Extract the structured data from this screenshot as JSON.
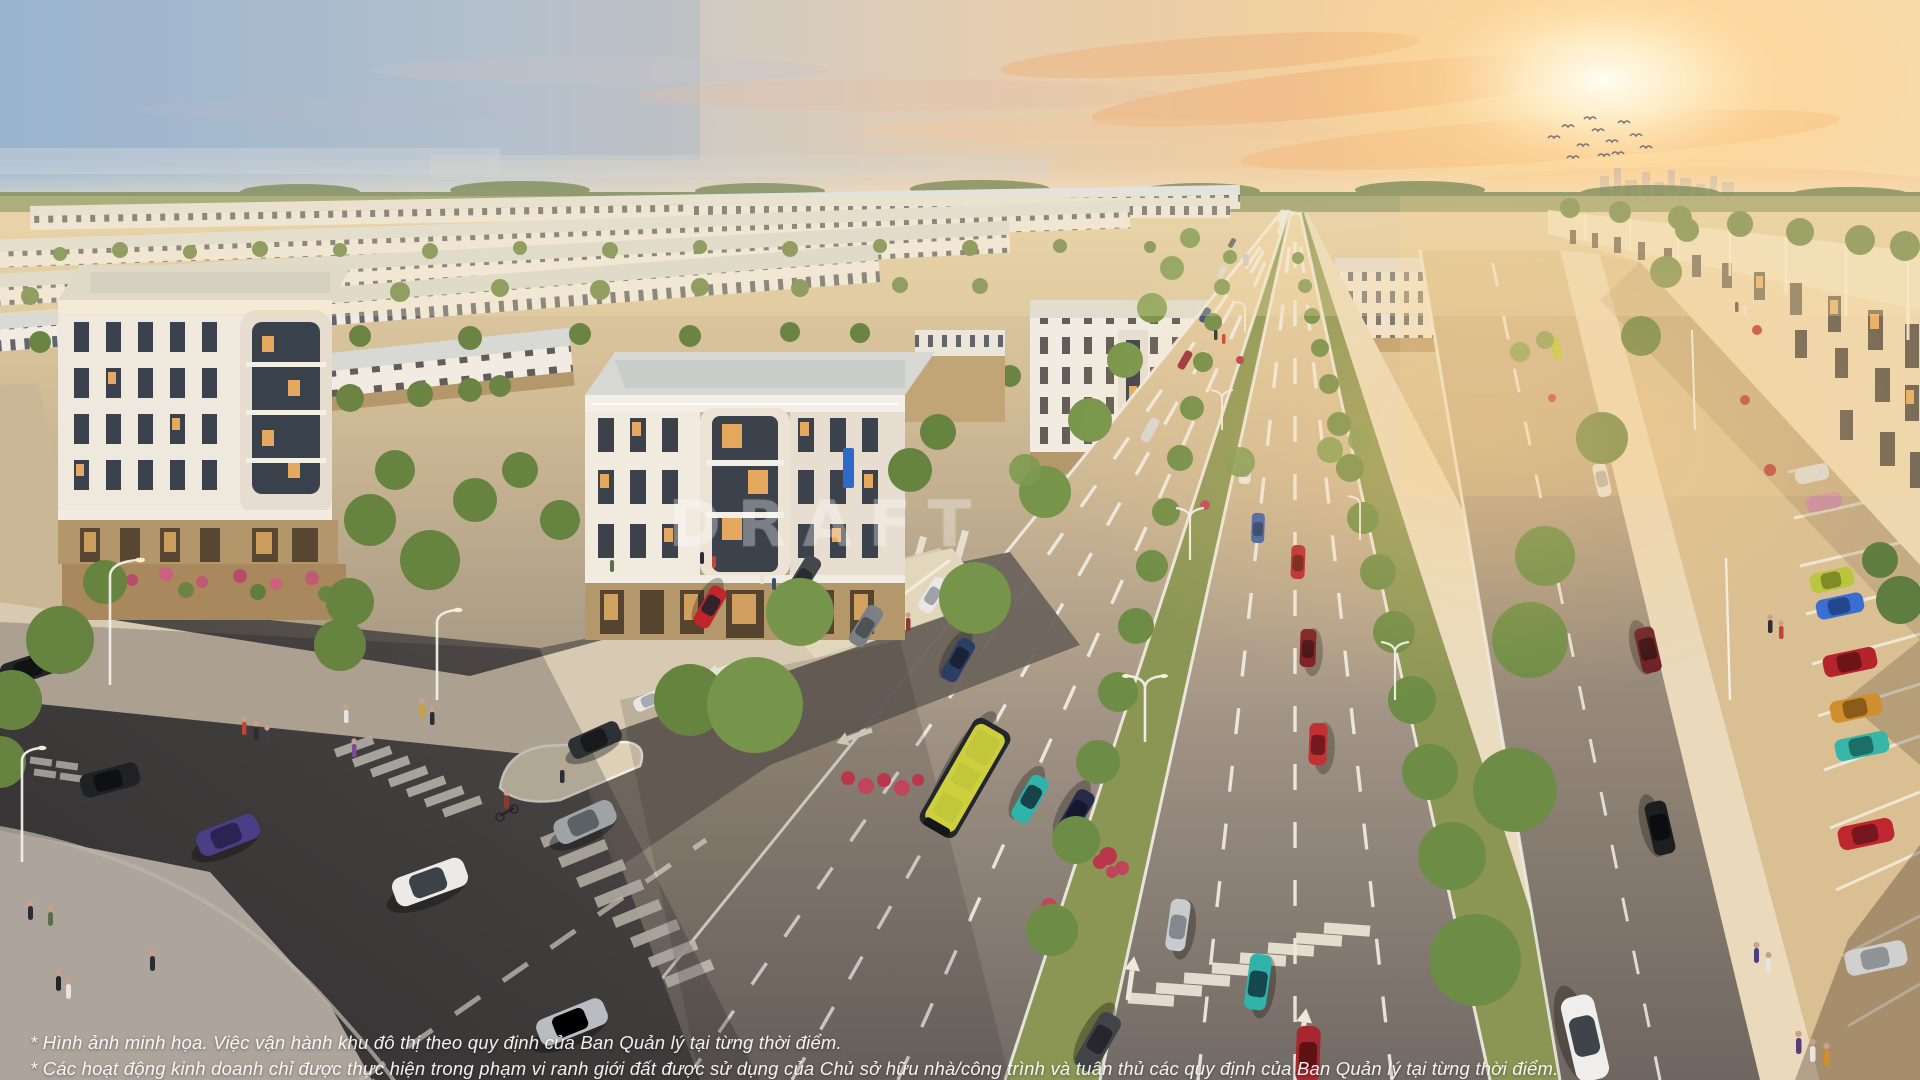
{
  "watermark": {
    "text": "DRAFT"
  },
  "disclaimer": {
    "line1": "* Hình ảnh minh họa. Việc vận hành khu đô thị theo quy định của Ban Quản lý tại từng thời điểm.",
    "line2": "* Các hoạt động kinh doanh chỉ được thực hiện trong phạm vi ranh giới đất được sử dụng của Chủ sở hữu nhà/công trình và tuân thủ các quy định của Ban Quản lý tại từng thời điểm."
  },
  "scene": {
    "description": "Sunset aerial rendering of a master-planned township: curving rows of white neoclassical shophouses, a wide tree-lined boulevard with traffic, roadside parking with colorful cars, and pedestrians on sidewalks",
    "palette": {
      "sky_blue": "#9db8d2",
      "sunset_peach": "#f8d9a8",
      "sun_glow": "#fffdf2",
      "haze": "#f2e3c8",
      "facade_white": "#f0eade",
      "roof_gray": "#d8d9d4",
      "storefront_tan": "#b4976b",
      "boulevard_far": "#e8d0a8",
      "boulevard_near": "#716a64",
      "cross_street": "#423f3e",
      "grass": "#8b9655",
      "tree_green": "#66833f",
      "sidewalk": "#e9dcc0",
      "lane_marking": "#f2efe7",
      "bus_yellow": "#cde03c"
    },
    "vehicle_colors": [
      "#c2242c",
      "#e9e8e4",
      "#2b3e63",
      "#2fb3ab",
      "#252c4a",
      "#4a3f86",
      "#9fa3a6",
      "#b8c63e",
      "#3a6ed0",
      "#b3242c",
      "#cf8f2e",
      "#36b5a8",
      "#bf2730",
      "#cfd0cf",
      "#1c1e21",
      "#6d2026",
      "#cdd03c"
    ]
  }
}
